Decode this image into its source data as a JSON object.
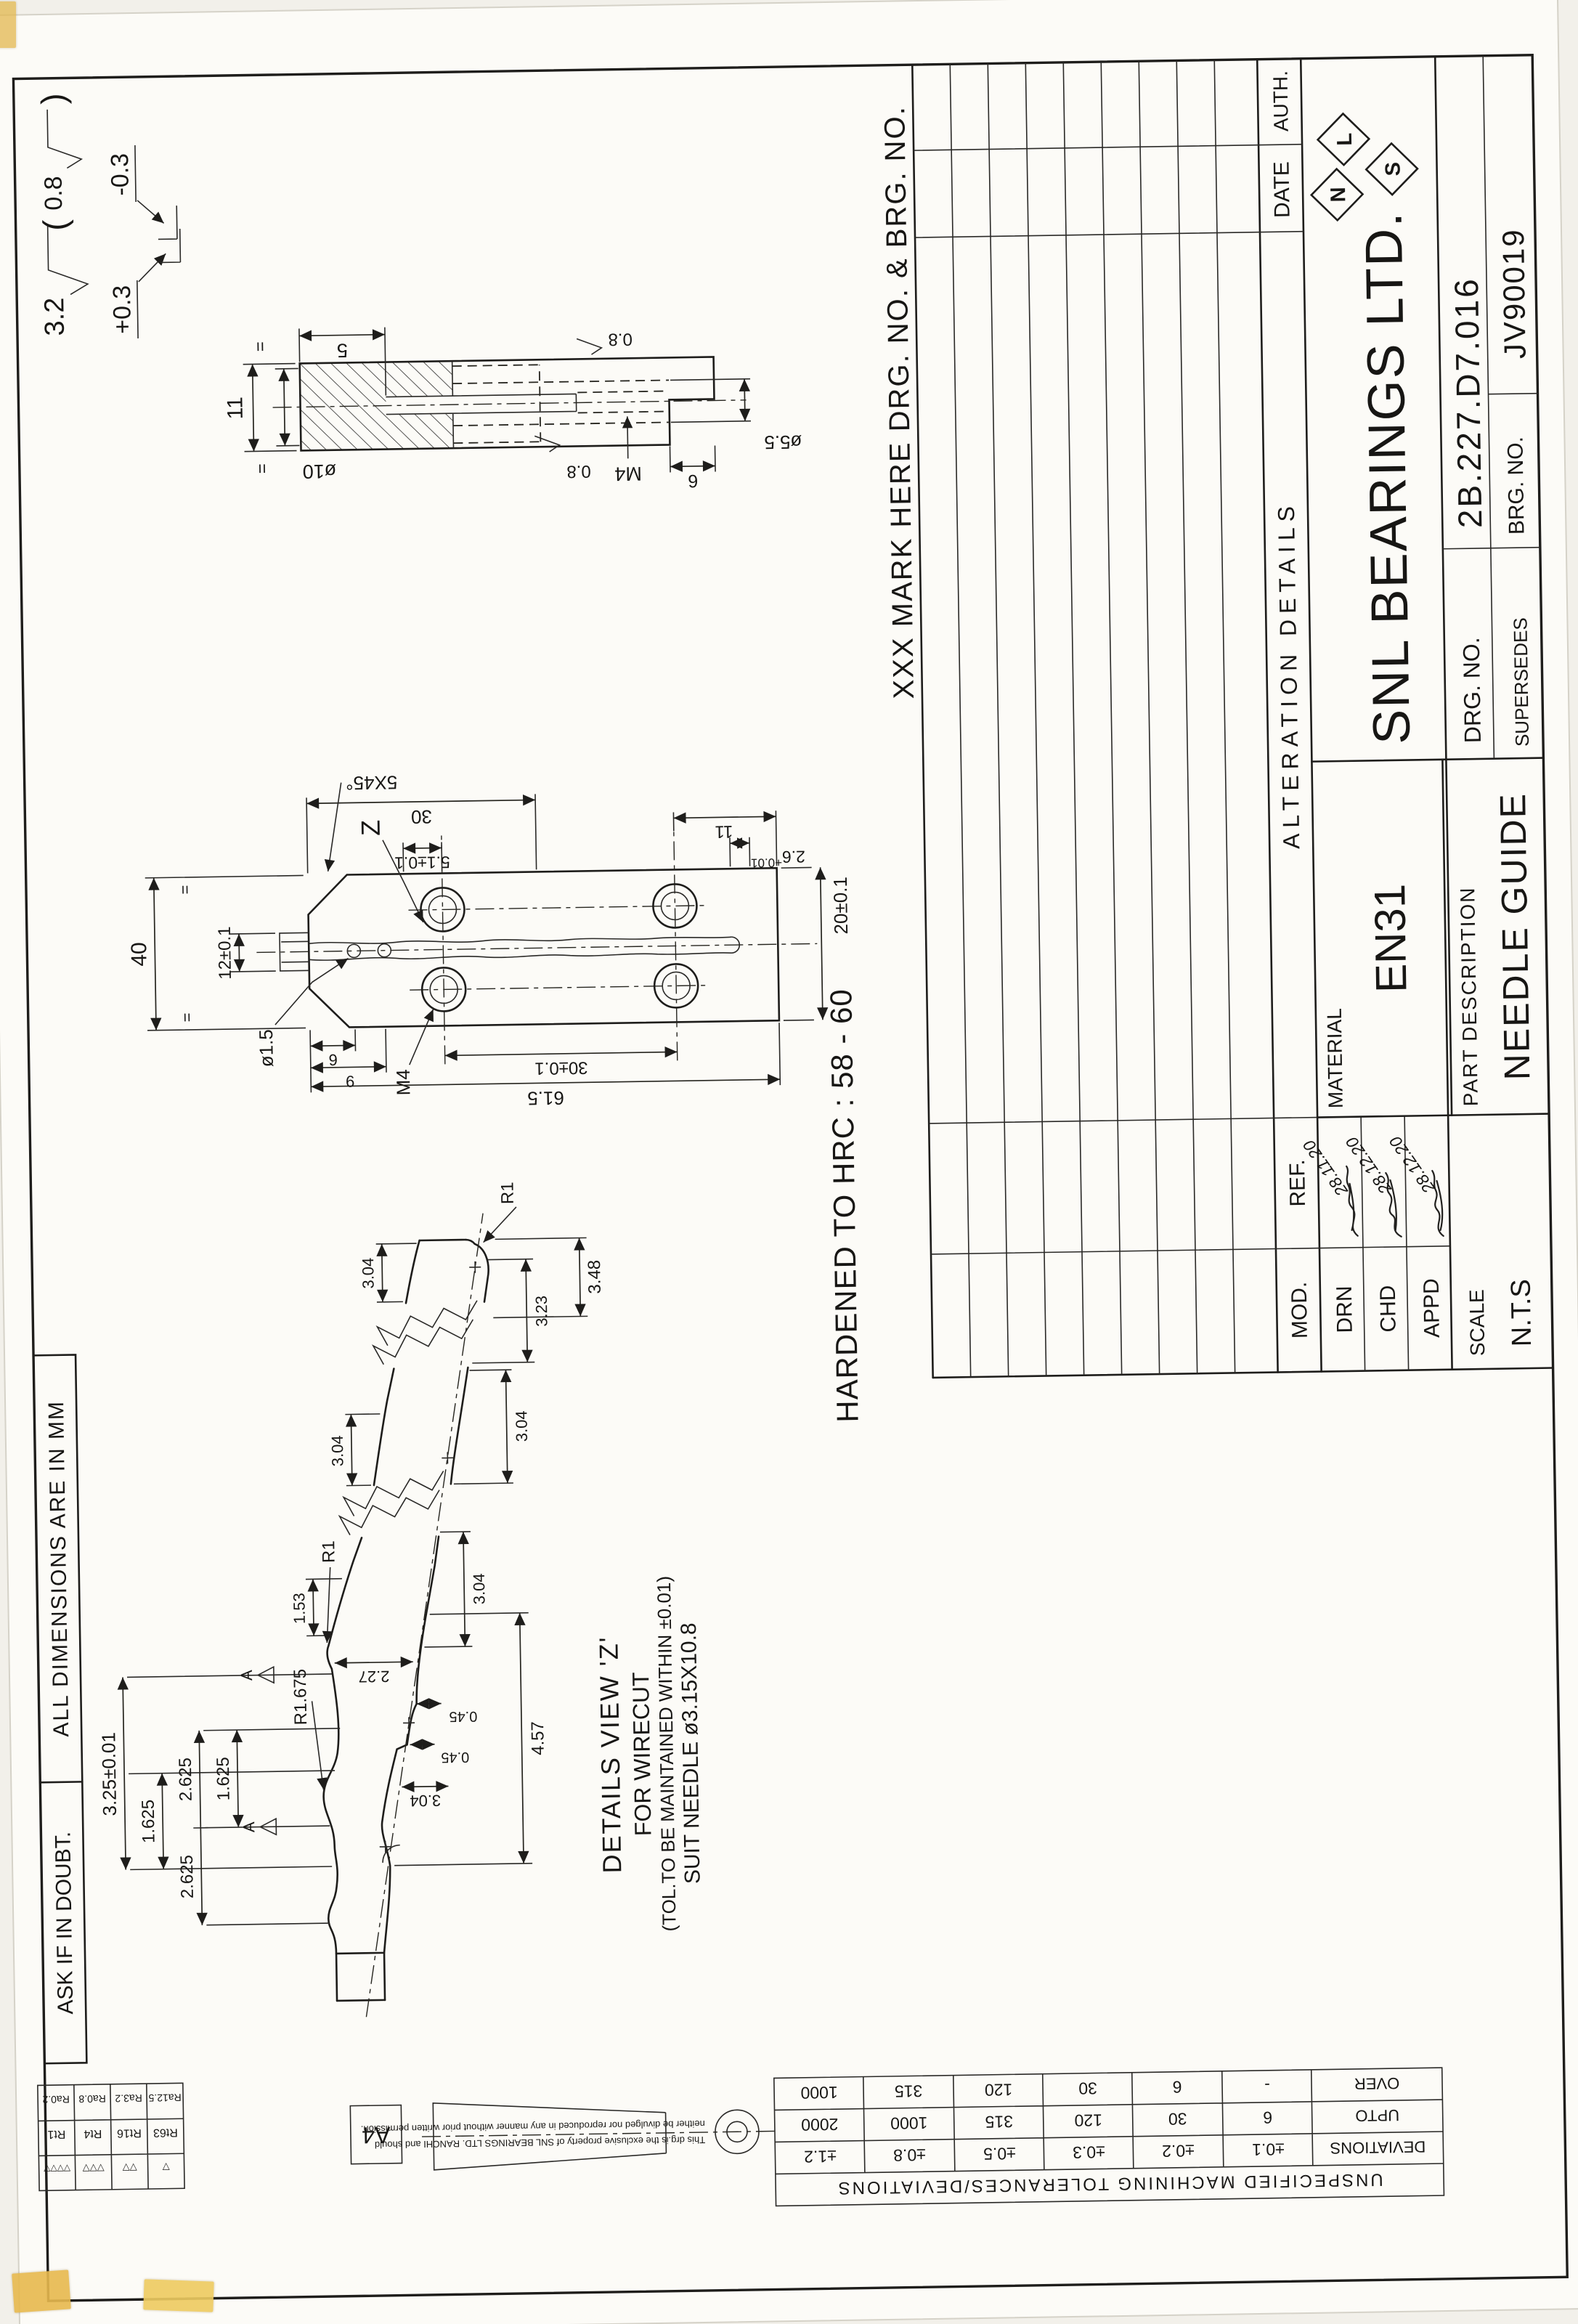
{
  "strip": {
    "ask": "ASK IF IN DOUBT.",
    "units": "ALL DIMENSIONS ARE IN MM"
  },
  "finish_note": {
    "general": "3.2",
    "alt_open": "(",
    "alt": "0.8",
    "alt_close": ")",
    "edge_plus": "+0.3",
    "edge_minus": "-0.3"
  },
  "notes": {
    "mark": "XXX MARK HERE DRG. NO. & BRG. NO.",
    "hardness": "HARDENED TO HRC : 58 - 60"
  },
  "section_view": {
    "dims": {
      "d5": "5",
      "d10": "ø10",
      "m4": "M4",
      "d55": "ø5.5",
      "d6": "6",
      "d11": "11",
      "eq": "=",
      "f08": "0.8"
    }
  },
  "plan_view": {
    "dims": {
      "d40": "40",
      "eq": "=",
      "d30": "30",
      "chamfer": "5X45°",
      "d12": "12±0.1",
      "d15": "ø1.5",
      "m4": "M4",
      "z": "Z",
      "d9": "9",
      "d6": "6",
      "d51": "5.1±0.1",
      "d20": "20±0.1",
      "d26": "2.6",
      "d26tol": "+0.01",
      "d301": "30±0.1",
      "d11": "11",
      "d615": "61.5"
    }
  },
  "detail_z": {
    "dims": {
      "d325": "3.25±0.01",
      "d1625": "1.625",
      "d2625": "2.625",
      "d153": "1.53",
      "r1": "R1",
      "r1675": "R1.675",
      "d227": "2.27",
      "d304": "3.04",
      "d045": "0.45",
      "d457": "4.57",
      "d323": "3.23",
      "d348": "3.48",
      "datum": "A"
    },
    "labels": [
      "DETAILS VIEW 'Z'",
      "FOR WIRECUT",
      "(TOL.TO BE MAINTAINED WITHIN ±0.01)",
      "SUIT NEEDLE ø3.15X10.8"
    ]
  },
  "title_block": {
    "headers": {
      "mod": "MOD.",
      "ref": "REF.",
      "alteration": "ALTERATION DETAILS",
      "date": "DATE",
      "auth": "AUTH."
    },
    "signatures": [
      {
        "role": "DRN",
        "date": "28.11.20"
      },
      {
        "role": "CHD",
        "date": "28.12.20"
      },
      {
        "role": "APPD",
        "date": "28.12.20"
      }
    ],
    "material_label": "MATERIAL",
    "material": "EN31",
    "part_desc_label": "PART DESCRIPTION",
    "part_desc": "NEEDLE GUIDE",
    "scale_label": "SCALE",
    "scale": "N.T.S",
    "company": "SNL BEARINGS LTD.",
    "logo_letters": [
      "N",
      "L",
      "S"
    ],
    "drg_label": "DRG. NO.",
    "drg_no": "2B.227.D7.016",
    "brg_label": "BRG. NO.",
    "brg_no": "JV90019",
    "supersedes": "SUPERSEDES"
  },
  "tolerance_table": {
    "caption": "UNSPECIFIED MACHINING TOLERANCES/DEVIATIONS",
    "row_labels": [
      "DEVIATIONS",
      "UPTO",
      "OVER"
    ],
    "deviations": [
      "±0.1",
      "±0.2",
      "±0.3",
      "±0.5",
      "±0.8",
      "±1.2"
    ],
    "upto": [
      "6",
      "30",
      "120",
      "315",
      "1000",
      "2000"
    ],
    "over": [
      "-",
      "6",
      "30",
      "120",
      "315",
      "1000"
    ]
  },
  "roughness_table": {
    "symbols": [
      "▽",
      "▽▽",
      "▽▽▽",
      "▽▽▽▽"
    ],
    "rt": [
      "Rt63",
      "Rt16",
      "Rt4",
      "Rt1"
    ],
    "ra": [
      "Ra12.5",
      "Ra3.2",
      "Ra0.8",
      "Ra0.2"
    ]
  },
  "sheet": {
    "size_label": "A4",
    "note_line1": "This drg.is the exclusive property of SNL BEARINGS LTD. RANCHI and should",
    "note_line2": "neither be divulged nor reproduced in any manner without prior written permission."
  }
}
